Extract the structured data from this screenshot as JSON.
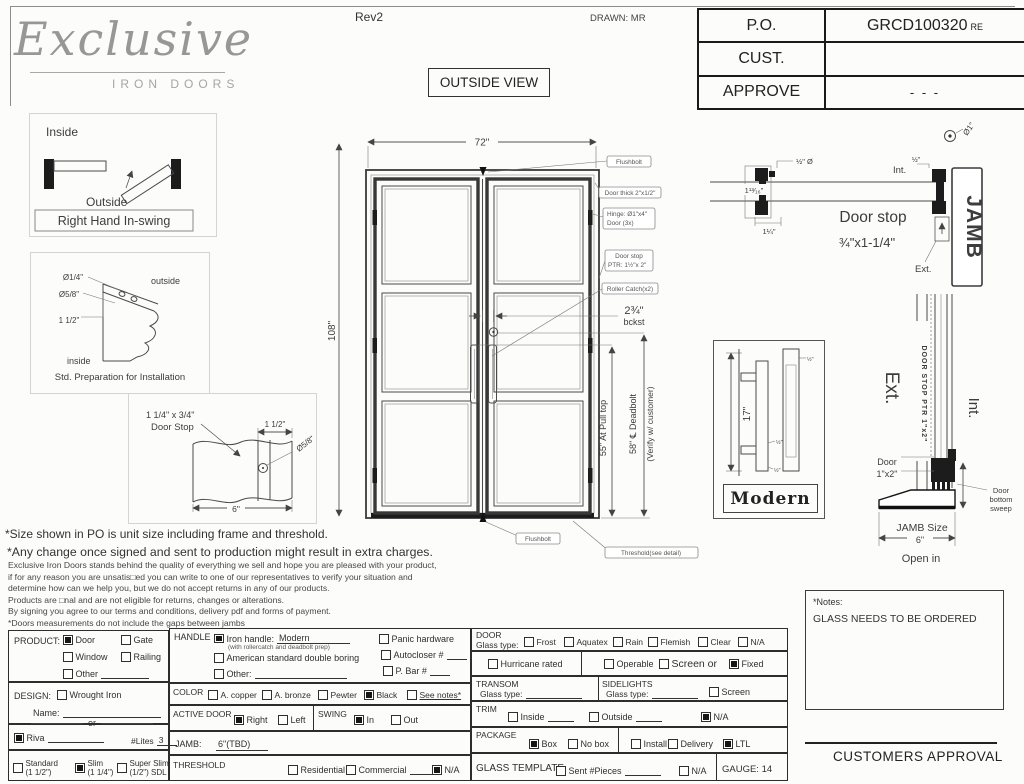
{
  "sheet": {
    "rev": "Rev2",
    "drawn": "DRAWN: MR",
    "view": "OUTSIDE VIEW",
    "logo": {
      "script": "Exclusive",
      "sub": "IRON DOORS"
    },
    "po": {
      "rows": [
        {
          "label": "P.O.",
          "value": "GRCD100320",
          "suffix": "RE"
        },
        {
          "label": "CUST.",
          "value": ""
        },
        {
          "label": "APPROVE",
          "value": "- - -"
        }
      ]
    }
  },
  "swing": {
    "inside": "Inside",
    "outside": "Outside",
    "caption": "Right Hand In-swing"
  },
  "prep": {
    "d14": "Ø1/4\"",
    "d58": "Ø5/8\"",
    "d112": "1 1/2\"",
    "outside": "outside",
    "inside": "inside",
    "caption": "Std. Preparation for Installation"
  },
  "stopdet": {
    "t1": "1 1/4\" x 3/4\"",
    "t2": "Door Stop",
    "d112": "1 1/2\"",
    "d58": "Ø5/8\"",
    "w6": "6\""
  },
  "door": {
    "w": "72\"",
    "h": "108\"",
    "flushbolt": "Flushbolt",
    "thick": "Door thick 2\"x1/2\"",
    "hinge1": "Hinge: Ø1\"x4\"",
    "hinge2": "Door (3x)",
    "stop1": "Door stop",
    "stop2": "PTR: 1½\"x 2\"",
    "roller": "Roller Catch(x2)",
    "bck1": "2¾\"",
    "bck2": "bckst",
    "pull": "55\" At Pull top",
    "dead1": "58\" ℄ Deadbolt",
    "dead2": "(Verify w/ customer)",
    "flushbolt2": "Flushbolt",
    "threshold": "Threshold(see detail)"
  },
  "jamb": {
    "halfdia": "½\" Ø",
    "d1316": "1¹³⁄₁₆\"",
    "d114": "1¼\"",
    "int": "Int.",
    "half": "½\"",
    "dia1": "Ø1\"",
    "jamb": "JAMB",
    "stop": "Door stop",
    "size": "¾\"x1-1/4\"",
    "ext": "Ext."
  },
  "handle": {
    "h17": "17\"",
    "label": "Modern",
    "s1": "½\"",
    "s2": "½\"",
    "s3": "½\""
  },
  "thr": {
    "ext": "Ext.",
    "int": "Int.",
    "stoptxt": "DOOR STOP PTR 1\"x2\"",
    "door1": "Door",
    "door2": "1\"x2\"",
    "sw1": "Door",
    "sw2": "bottom",
    "sw3": "sweep",
    "js": "JAMB Size",
    "six": "6\"",
    "open": "Open in"
  },
  "notes": {
    "a": "*Size shown in PO is unit size including frame and threshold.",
    "b": "*Any change once signed and sent to production might result in extra charges.",
    "lines": [
      "Exclusive Iron Doors stands behind the quality of everything we sell and hope you are pleased with your product,",
      "if for any reason you are unsatis□ed you can write to one of our representatives to verify your situation and",
      "determine how can we help you, but we do not accept returns in any of our products.",
      "Products are □nal and are not eligible for returns, changes or alterations.",
      "By signing you agree to our terms and conditions, delivery pdf and forms of payment.",
      "*Doors measurements do not include the gaps between jambs"
    ]
  },
  "form": {
    "product": {
      "label": "PRODUCT:",
      "door": {
        "label": "Door",
        "checked": true
      },
      "gate": {
        "label": "Gate",
        "checked": false
      },
      "window": {
        "label": "Window",
        "checked": false
      },
      "railing": {
        "label": "Railing",
        "checked": false
      },
      "other": {
        "label": "Other",
        "checked": false
      }
    },
    "design": {
      "label": "DESIGN:",
      "wrought": {
        "label": "Wrought Iron",
        "checked": false
      },
      "name": "Name:",
      "or": "or"
    },
    "riva": {
      "label": "Riva",
      "checked": true,
      "lites": "#Lites",
      "litesval": "3"
    },
    "thick": {
      "standard": {
        "label": "Standard",
        "sub": "(1 1/2\")",
        "checked": false
      },
      "slim": {
        "label": "Slim",
        "sub": "(1 1/4\")",
        "checked": true
      },
      "superslim": {
        "label": "Super Slim",
        "sub": "(1/2\") SDL",
        "checked": false
      }
    },
    "handle": {
      "label": "HANDLE",
      "iron": {
        "label": "Iron handle:",
        "value": "Modern",
        "sub": "(with rollercatch and deadbolt prep)",
        "checked": true
      },
      "american": {
        "label": "American standard double boring",
        "checked": false
      },
      "other": {
        "label": "Other:",
        "checked": false
      },
      "panic": {
        "label": "Panic hardware",
        "checked": false
      },
      "auto": {
        "label": "Autocloser #",
        "checked": false
      },
      "pbar": {
        "label": "P. Bar #",
        "checked": false
      }
    },
    "color": {
      "label": "COLOR",
      "copper": {
        "label": "A. copper",
        "checked": false
      },
      "bronze": {
        "label": "A. bronze",
        "checked": false
      },
      "pewter": {
        "label": "Pewter",
        "checked": false
      },
      "black": {
        "label": "Black",
        "checked": true
      },
      "seenotes": {
        "label": "See notes*",
        "checked": false
      }
    },
    "active": {
      "label": "ACTIVE DOOR",
      "right": {
        "label": "Right",
        "checked": true
      },
      "left": {
        "label": "Left",
        "checked": false
      }
    },
    "swingsec": {
      "label": "SWING",
      "in": {
        "label": "In",
        "checked": true
      },
      "out": {
        "label": "Out",
        "checked": false
      }
    },
    "jamb": {
      "label": "JAMB:",
      "value": "6\"(TBD)"
    },
    "threshold": {
      "label": "THRESHOLD",
      "res": {
        "label": "Residential",
        "checked": false
      },
      "com": {
        "label": "Commercial",
        "checked": false
      },
      "na": {
        "label": "N/A",
        "checked": true
      }
    },
    "doorsec": {
      "label": "DOOR",
      "glass": "Glass type:",
      "frost": {
        "label": "Frost",
        "checked": false
      },
      "aquatex": {
        "label": "Aquatex",
        "checked": false
      },
      "rain": {
        "label": "Rain",
        "checked": false
      },
      "flemish": {
        "label": "Flemish",
        "checked": false
      },
      "clear": {
        "label": "Clear",
        "checked": false
      },
      "na": {
        "label": "N/A",
        "checked": false
      }
    },
    "rated": {
      "hurricane": {
        "label": "Hurricane rated",
        "checked": false
      },
      "operable": {
        "label": "Operable",
        "checked": false
      },
      "screenor": {
        "label": "Screen or",
        "checked": false
      },
      "fixed": {
        "label": "Fixed",
        "checked": true
      }
    },
    "transom": {
      "label": "TRANSOM",
      "glass": "Glass type:"
    },
    "sidelights": {
      "label": "SIDELIGHTS",
      "glass": "Glass type:",
      "screen": {
        "label": "Screen",
        "checked": false
      }
    },
    "trim": {
      "label": "TRIM",
      "inside": {
        "label": "Inside",
        "checked": false
      },
      "outside": {
        "label": "Outside",
        "checked": false
      },
      "na": {
        "label": "N/A",
        "checked": true
      }
    },
    "pack": {
      "label": "PACKAGE",
      "box": {
        "label": "Box",
        "checked": true
      },
      "nobox": {
        "label": "No box",
        "checked": false
      },
      "install": {
        "label": "Install",
        "checked": false
      },
      "delivery": {
        "label": "Delivery",
        "checked": false
      },
      "ltl": {
        "label": "LTL",
        "checked": true
      }
    },
    "template": {
      "label": "GLASS TEMPLATE",
      "sent": {
        "label": "Sent #Pieces",
        "checked": false
      },
      "na": {
        "label": "N/A",
        "checked": false
      },
      "gauge": "GAUGE: 14"
    }
  },
  "notesbox": {
    "title": "*Notes:",
    "body": "GLASS NEEDS TO BE ORDERED"
  },
  "approval": "CUSTOMERS APPROVAL"
}
